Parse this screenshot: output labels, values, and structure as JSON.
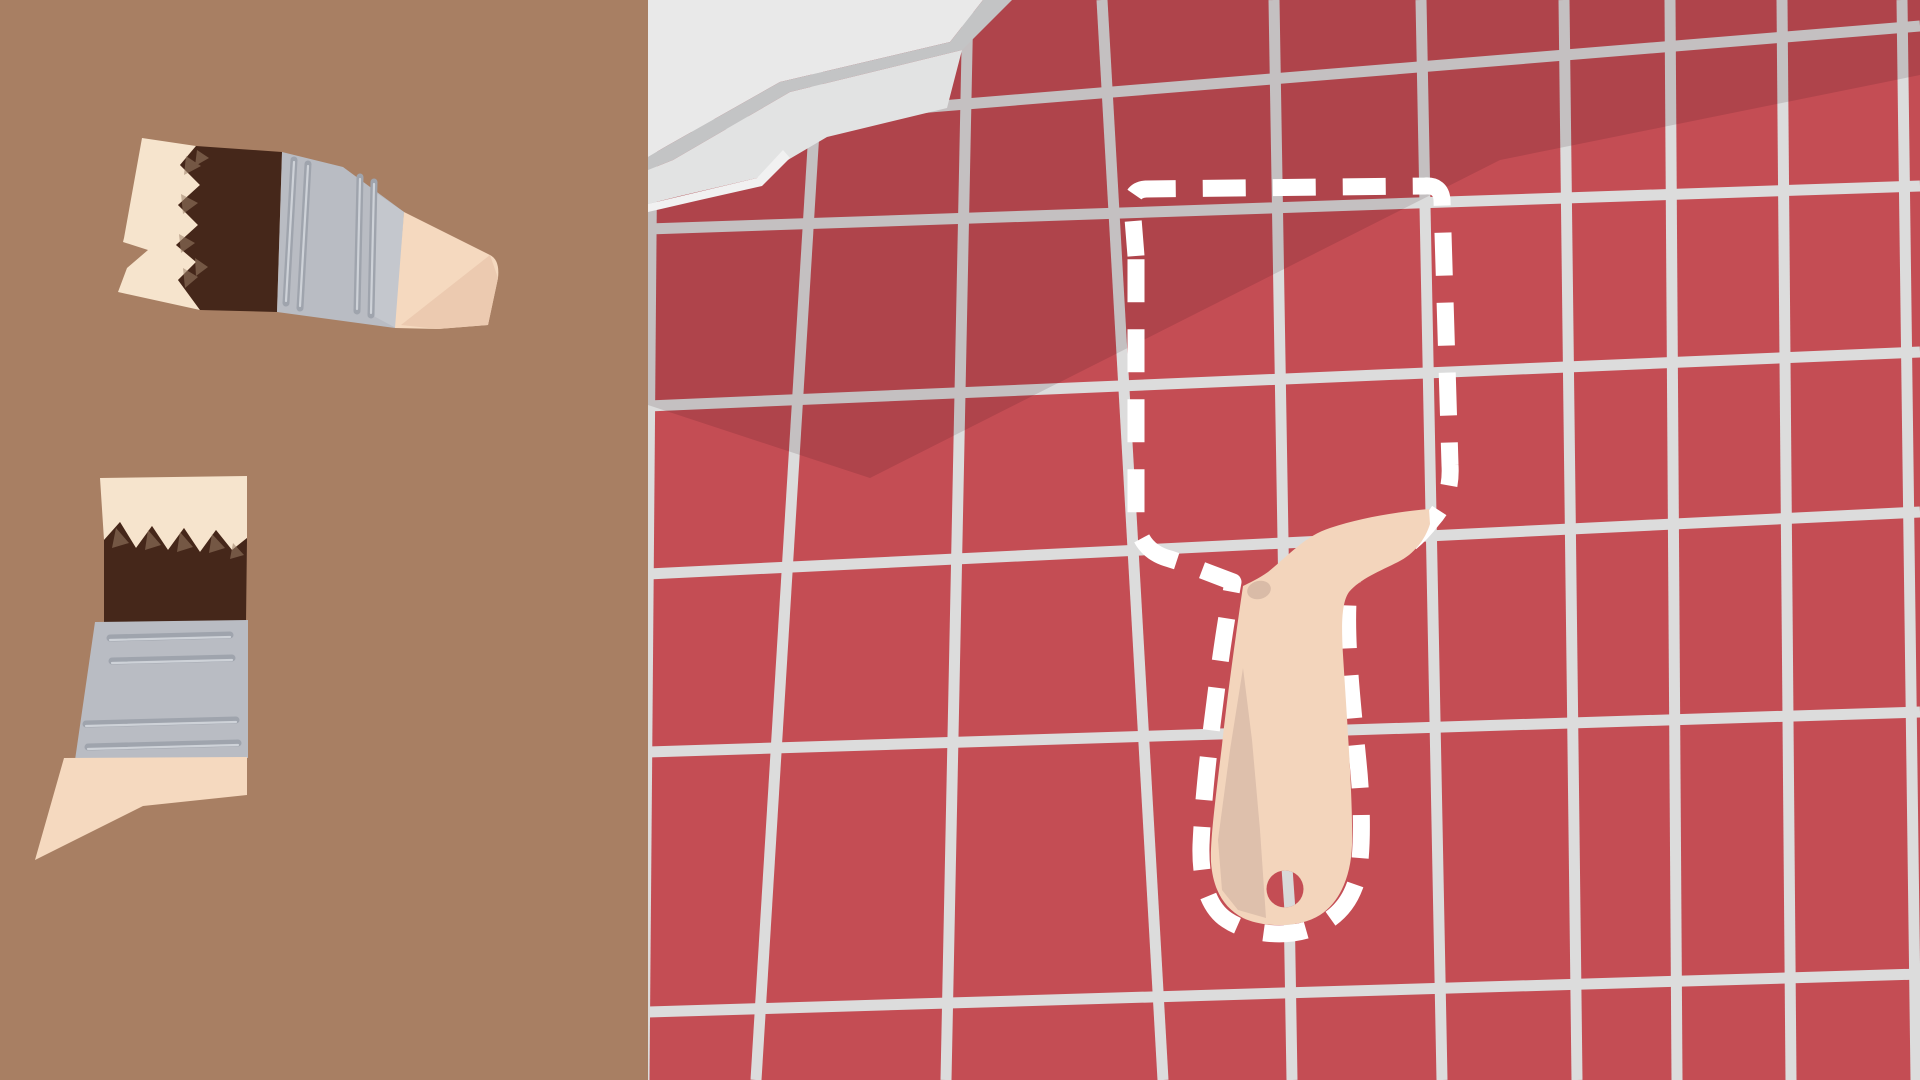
{
  "scene": {
    "type": "drag-and-drop repair puzzle illustration",
    "tray_label": "loose paintbrush pieces tray",
    "wall_label": "red tiled wall with dust sheet",
    "target_label": "dashed putty-knife silhouette with wooden handle placed"
  },
  "colors": {
    "tray_bg": "#a87f63",
    "tile_red": "#c44d54",
    "wall_shadow": "rgba(40,8,12,0.13)",
    "grout": "#dcdcdc",
    "dash_white": "#ffffff",
    "sheet_body": "#e9e9e9",
    "sheet_fold_band": "#c3c4c5",
    "sheet_layer2": "#e2e3e3",
    "sheet_edge_strip": "#f1f1f1",
    "bristle_cream": "#f6e4cd",
    "paint_brown": "#45271a",
    "bristle_speckle": "#9b7f68",
    "ferrule_silver": "#b9bcc3",
    "ferrule_silver_light": "#c4c7cd",
    "ferrule_groove": "#9fa4ad",
    "ferrule_groove_light": "#ced2d8",
    "wood_beige": "#f5d9bf",
    "wood_fold": "#eccab0",
    "handle_beige": "#f3d5bc",
    "handle_shade": "#dec0ac",
    "handle_spot": "#d9bba7",
    "hole_grout": "#d9d9d9"
  }
}
